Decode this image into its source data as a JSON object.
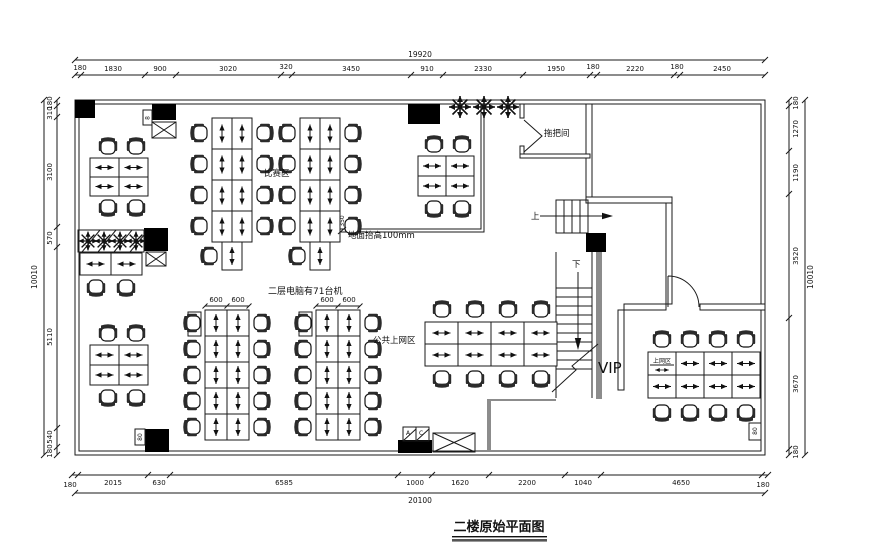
{
  "title": "二楼原始平面图",
  "labels": {
    "competition": "比赛区",
    "mop_room": "拖把间",
    "floor_raised": "地面抬高100mm",
    "computers_note": "二层电脑有71台机",
    "public_area": "公共上网区",
    "vip": "VIP",
    "vip_area": "上网区",
    "up": "上",
    "down": "下",
    "ac_a": "A",
    "ac_c": "C"
  },
  "dims": {
    "top": {
      "total": "19920",
      "values": [
        "180",
        "1830",
        "900",
        "3020",
        "320",
        "3450",
        "910",
        "2330",
        "1950",
        "180",
        "2220",
        "180",
        "2450"
      ]
    },
    "bottom": {
      "total": "20100",
      "values": [
        "180",
        "2015",
        "630",
        "6585",
        "1000",
        "1620",
        "2200",
        "1040",
        "4650",
        "180"
      ]
    },
    "left": {
      "total": "10010",
      "values": [
        "180",
        "310",
        "3100",
        "570",
        "5110",
        "540",
        "180"
      ]
    },
    "right": {
      "total": "10010",
      "values": [
        "180",
        "1270",
        "1190",
        "3520",
        "3670",
        "180"
      ]
    },
    "desk_width_a": "600",
    "desk_width_b": "600",
    "desk_depth": "750",
    "platform_step": "350"
  },
  "tags": {
    "top_left": "8",
    "bottom_left": "80",
    "vip_corner": "80"
  },
  "colors": {
    "line": "#1a1a1a",
    "shaft_wall": "#8c8c8c",
    "fill_black": "#000000"
  }
}
